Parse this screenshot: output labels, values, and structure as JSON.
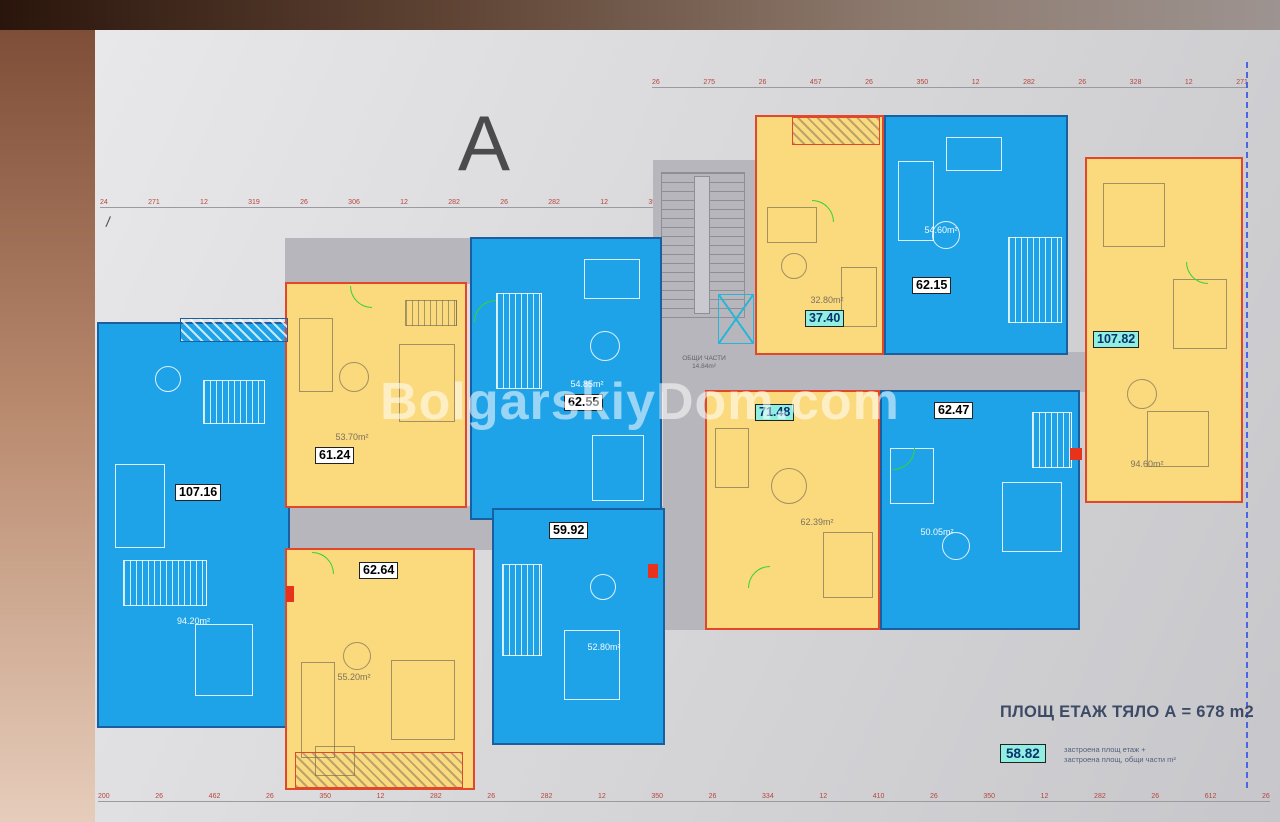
{
  "plan": {
    "body_letter": "A",
    "watermark": "BolgarskiyDom.com",
    "slash_mark": "/",
    "common_area": {
      "line1": "ОБЩИ ЧАСТИ",
      "line2": "14.84m²"
    }
  },
  "apartments": [
    {
      "unit_value": "107.16",
      "area_text": "94.20m²",
      "color": "blue",
      "highlight": false
    },
    {
      "unit_value": "61.24",
      "area_text": "53.70m²",
      "color": "yellow",
      "highlight": false
    },
    {
      "unit_value": "62.64",
      "area_text": "55.20m²",
      "color": "yellow",
      "highlight": false
    },
    {
      "unit_value": "62.55",
      "area_text": "54.85m²",
      "color": "blue",
      "highlight": false
    },
    {
      "unit_value": "59.92",
      "area_text": "52.80m²",
      "color": "blue",
      "highlight": false
    },
    {
      "unit_value": "37.40",
      "area_text": "32.80m²",
      "color": "yellow",
      "highlight": true
    },
    {
      "unit_value": "62.15",
      "area_text": "54.60m²",
      "color": "blue",
      "highlight": false
    },
    {
      "unit_value": "71.48",
      "area_text": "62.39m²",
      "color": "yellow",
      "highlight": true
    },
    {
      "unit_value": "62.47",
      "area_text": "50.05m²",
      "color": "blue",
      "highlight": false
    },
    {
      "unit_value": "107.82",
      "area_text": "94.60m²",
      "color": "yellow",
      "highlight": true
    }
  ],
  "summary": {
    "title": "ПЛОЩ ЕТАЖ ТЯЛО А = 678 m2",
    "highlight_value": "58.82",
    "note_line1": "застроена площ етаж +",
    "note_line2": "застроена площ, общи части m²"
  },
  "dimensions": {
    "top": [
      "26",
      "275",
      "26",
      "457",
      "26",
      "350",
      "12",
      "282",
      "26",
      "328",
      "12",
      "271"
    ],
    "left": [
      "24",
      "271",
      "12",
      "319",
      "26",
      "306",
      "12",
      "282",
      "26",
      "282",
      "12",
      "350"
    ],
    "bottom": [
      "200",
      "26",
      "462",
      "26",
      "350",
      "12",
      "282",
      "26",
      "282",
      "12",
      "350",
      "26",
      "334",
      "12",
      "410",
      "26",
      "350",
      "12",
      "282",
      "26",
      "612",
      "26"
    ]
  },
  "colors": {
    "apartment_blue": "#1fa3e8",
    "apartment_yellow": "#fbd97d",
    "wall_blue": "#1a5fa0",
    "wall_red": "#e2472b",
    "highlight_cyan": "#90efe0",
    "corridor_gray": "#b6b6bc",
    "dimension_red": "#b5453c",
    "axis_dashed_blue": "#4a66e0"
  }
}
